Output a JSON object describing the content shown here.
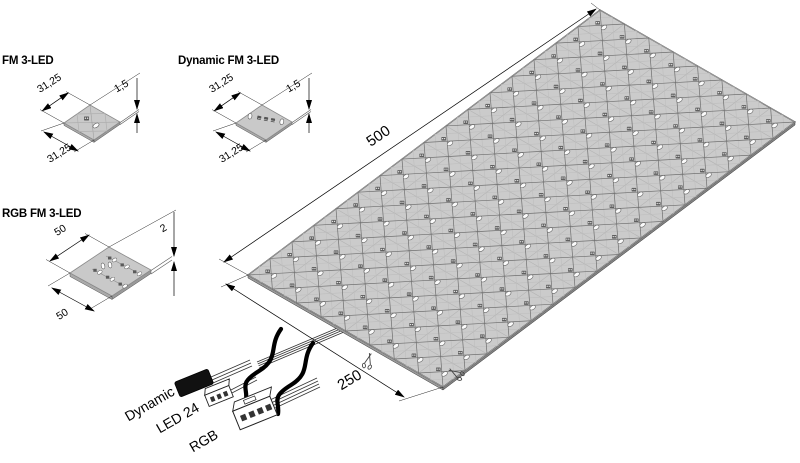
{
  "colors": {
    "panel_fill": "#cbcbcb",
    "module_fill": "#c9c9c9",
    "grid_line": "#b4b4b4",
    "lattice_line": "#6f6f6f",
    "diamond_line": "#bdbdbd",
    "led_chip": "#5f5f5f",
    "led_oval_fill": "#fbfbfb",
    "led_oval_stroke": "#666666",
    "edge_dark": "#3a3a3a",
    "sliver_left": "#9a9a9a",
    "sliver_right": "#828282"
  },
  "modules": [
    {
      "name": "FM 3-LED",
      "width": "31,25",
      "depth": "31,25",
      "height": "1,5"
    },
    {
      "name": "Dynamic FM 3-LED",
      "width": "31,25",
      "depth": "31,25",
      "height": "1,5"
    },
    {
      "name": "RGB FM 3-LED",
      "width": "50",
      "depth": "50",
      "height": "2"
    }
  ],
  "panel": {
    "length_label": "500",
    "width_label": "250",
    "cols": 16,
    "rows": 8
  },
  "connectors": {
    "dynamic": "Dynamic",
    "led24": "LED 24",
    "rgb": "RGB"
  }
}
